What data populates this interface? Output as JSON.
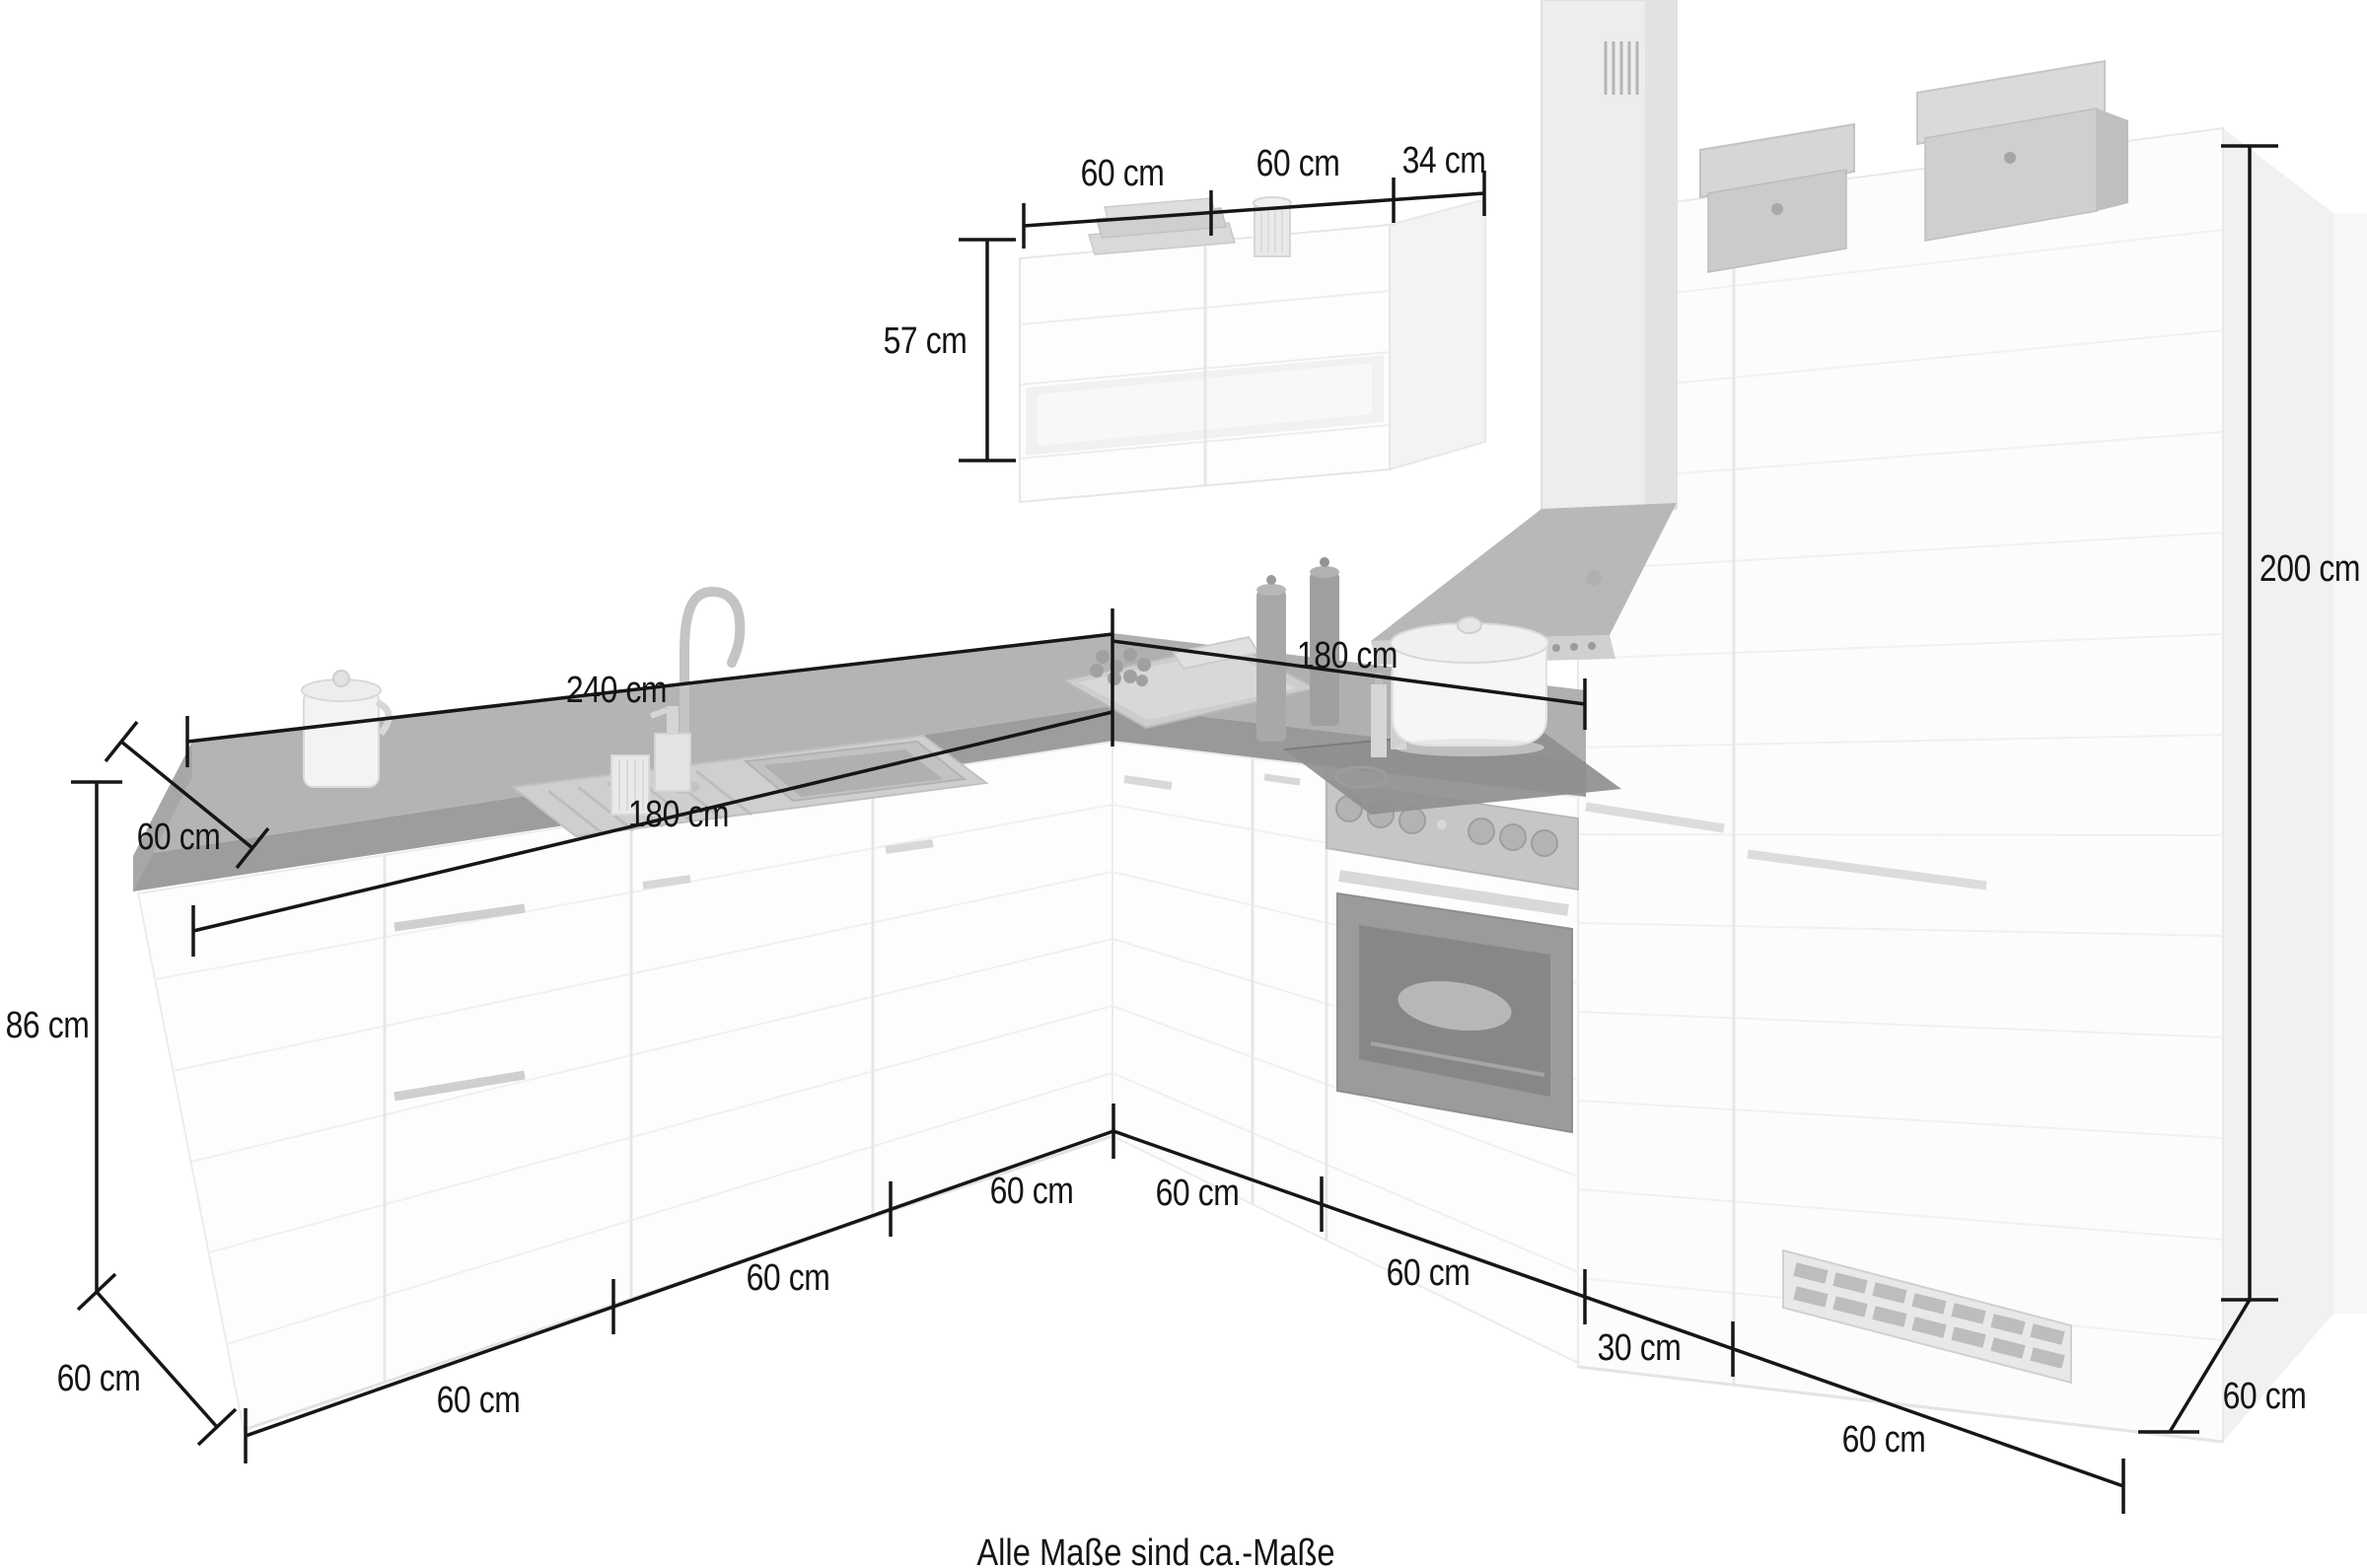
{
  "illustration": {
    "kind": "L-shaped kitchen unit with appliances, faded product drawing",
    "colors": {
      "worktop": "#b4b4b4",
      "worktop_front": "#9d9d9d",
      "cabinet_front": "#fdfdfd",
      "appliance_dark": "#8f8f8f",
      "dimension_line": "#161616"
    }
  },
  "dimensions": {
    "top_wall_unit_1": "60 cm",
    "top_wall_unit_2": "60 cm",
    "top_wall_depth": "34 cm",
    "wall_unit_height": "57 cm",
    "worktop_back_length": "240 cm",
    "worktop_front_length": "180 cm",
    "right_run_length": "180 cm",
    "worktop_depth": "60 cm",
    "base_unit_height": "86 cm",
    "tall_unit_height": "200 cm",
    "left_plinth_depth": "60 cm",
    "front_left_a": "60 cm",
    "front_left_b": "60 cm",
    "front_left_c": "60 cm",
    "front_right_a": "60 cm",
    "front_right_b": "60 cm",
    "front_right_c": "30 cm",
    "front_right_d": "60 cm",
    "tall_unit_depth": "60 cm"
  },
  "footer": {
    "note": "Alle Maße sind ca.-Maße"
  }
}
